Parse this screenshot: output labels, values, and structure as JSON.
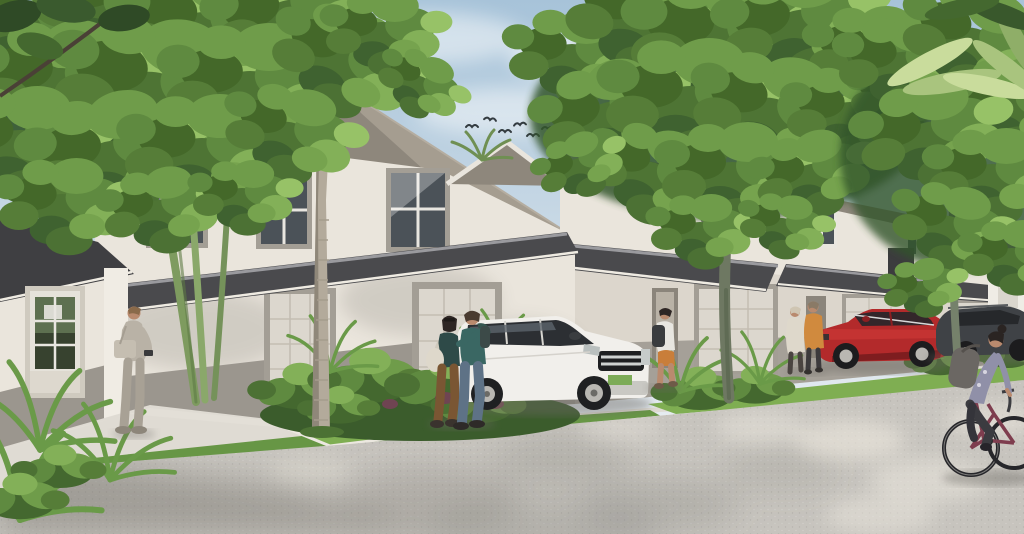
{
  "scene": {
    "kind": "architectural-exterior-rendering",
    "subject": "two-story townhome row on a sunny residential street",
    "time_of_day": "day",
    "objects": [
      "townhouse-row",
      "left-entry-door",
      "garage-doors",
      "upstairs-windows",
      "awning-roofs",
      "main-hip-roof",
      "palm-trees",
      "shade-trees",
      "tropical-planting-bed",
      "grass-strips",
      "sidewalk",
      "road",
      "white-suv",
      "red-car",
      "dark-suv",
      "bicyclist",
      "walking-couple",
      "standing-man-with-bag",
      "walker-with-backpack",
      "pair-by-red-car",
      "flock-of-birds",
      "clouds"
    ]
  },
  "colors": {
    "sky_top": "#a7c3d9",
    "sky_low": "#e6ecf1",
    "cloud": "#f4f7f9",
    "wall": "#eae5dc",
    "wall_shade": "#dcd6cc",
    "wainscot": "#9b968e",
    "roof": "#8e877c",
    "roof_light": "#a59d90",
    "awning": "#4a4a4d",
    "awning_dark": "#3f3f42",
    "awning_edge": "#9a9a9e",
    "garage_door": "#dcd7ce",
    "garage_trim": "#a39e95",
    "door_glass": "#5d7050",
    "glass": "#4b5258",
    "grass": "#679645",
    "grass_light": "#7fae52",
    "shrub_dark": "#3f6230",
    "shrub_mid": "#5f8a40",
    "shrub_light": "#83b058",
    "palm_trunk": "#b3aa9b",
    "palm_trunk_shade": "#8f8779",
    "tree_trunk": "#6e7862",
    "road": "#c7c4be",
    "road_shadow": "#6b6862",
    "sidewalk": "#dfdbd3",
    "curb": "#ece8e0",
    "suv_white": "#f1efeb",
    "car_red": "#b32a2b",
    "car_red_dark": "#7e1d1f",
    "suv_dark": "#3f4246",
    "bird": "#333b40",
    "skin": "#b98a6e",
    "teal_shirt": "#3a6763",
    "teal_top": "#2e4a48",
    "orange_jacket": "#d08a3e",
    "denim": "#5e7286",
    "beige_outfit": "#b9b2a6",
    "brown_pants": "#7a5633",
    "cyclist_shirt": "#9090a8"
  }
}
